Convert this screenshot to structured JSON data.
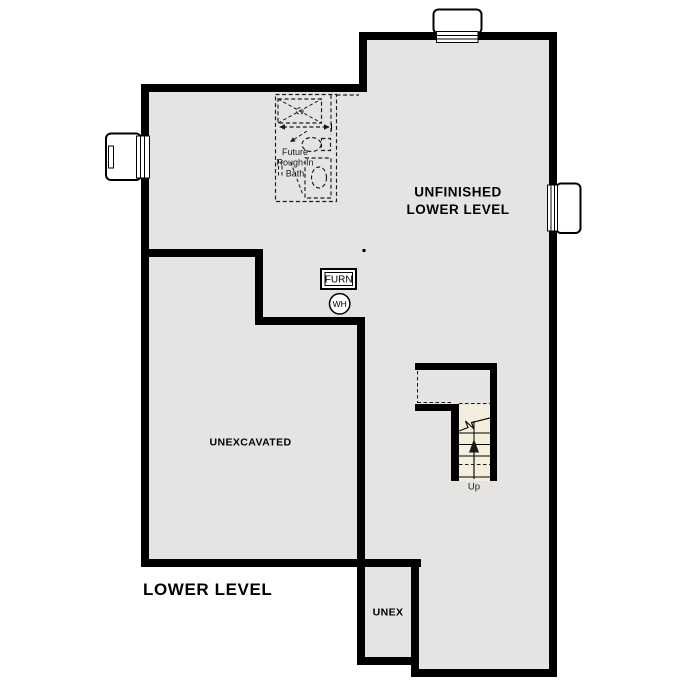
{
  "plan": {
    "title": "LOWER LEVEL",
    "rooms": {
      "unfinished": {
        "line1": "UNFINISHED",
        "line2": "LOWER LEVEL"
      },
      "unexcavated": {
        "label": "UNEXCAVATED"
      },
      "unex": {
        "label": "UNEX"
      }
    },
    "features": {
      "furnace": {
        "label": "FURN"
      },
      "water_heater": {
        "label": "WH"
      },
      "stairs": {
        "label": "Up"
      },
      "future_bath": {
        "line1": "Future",
        "line2": "Rough-In",
        "line3": "Bath"
      }
    },
    "colors": {
      "wall": "#000000",
      "floor": "#e5e4e2",
      "stairs": "#f4eedd",
      "background": "#ffffff",
      "window": "#ffffff"
    }
  }
}
